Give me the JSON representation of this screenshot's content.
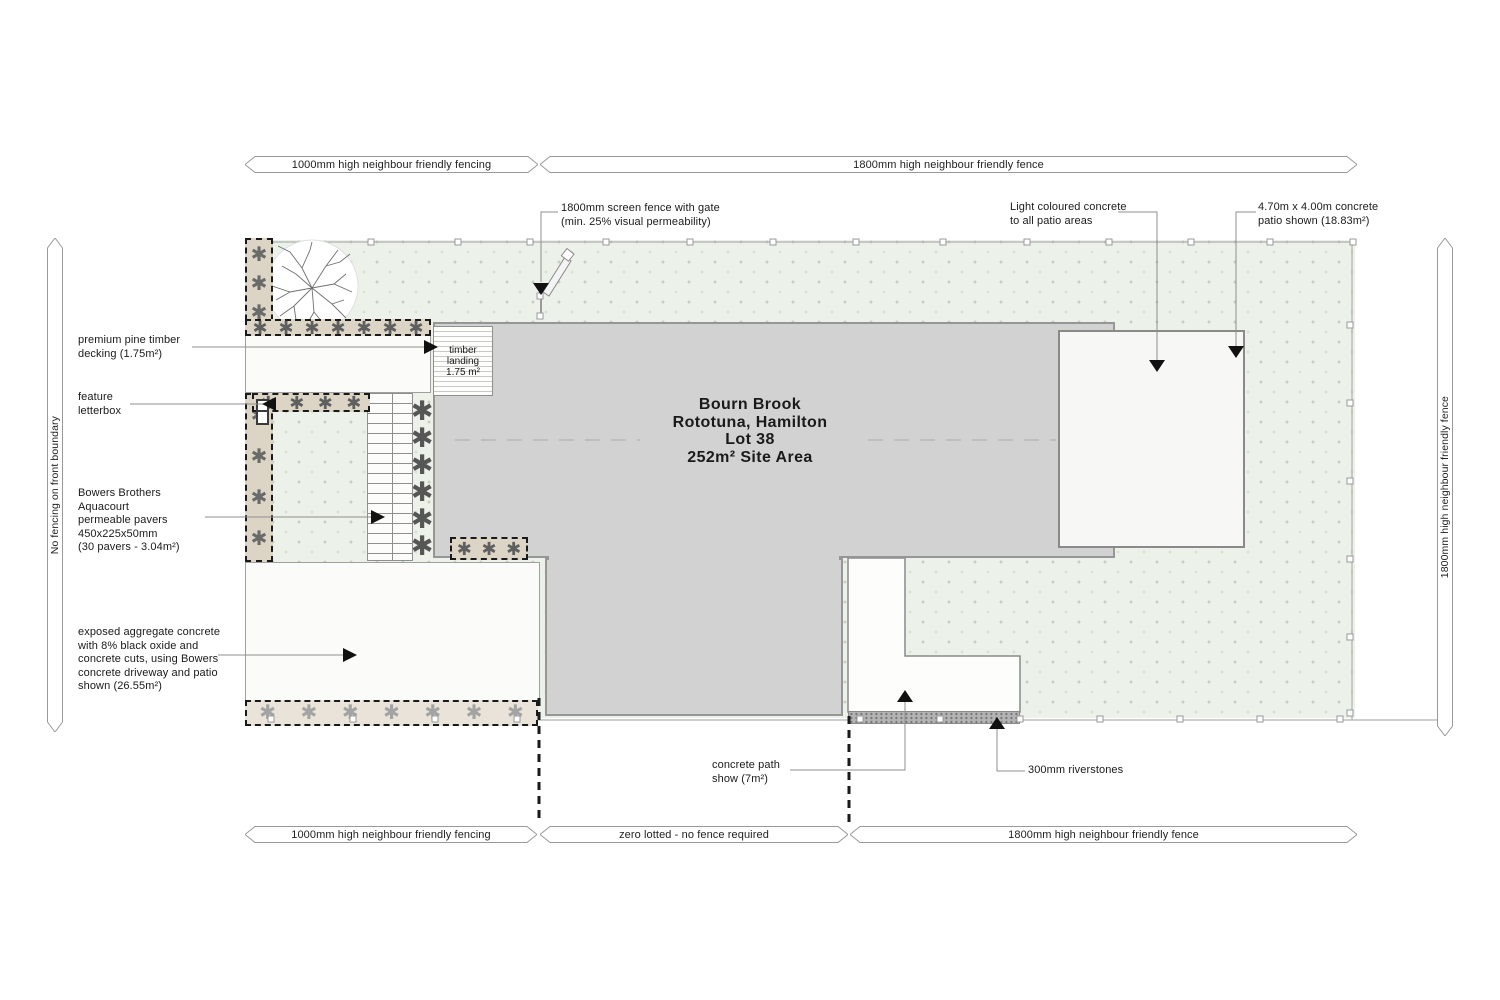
{
  "plan": {
    "title_lines": [
      "Bourn Brook",
      "Rototuna, Hamilton",
      "Lot 38",
      "252m² Site Area"
    ],
    "timber_landing": "timber\nlanding\n1.75 m²"
  },
  "fence_labels": {
    "top_left": "1000mm high neighbour friendly fencing",
    "top_right": "1800mm high neighbour friendly fence",
    "bottom_left": "1000mm high neighbour friendly fencing",
    "bottom_mid": "zero lotted - no fence required",
    "bottom_right": "1800mm high neighbour friendly fence",
    "left_vertical": "No fencing on front boundary",
    "right_vertical": "1800mm high neighbour friendly fence"
  },
  "annotations": {
    "screen_fence": "1800mm screen fence with gate\n(min. 25% visual permeability)",
    "light_concrete": "Light coloured concrete\nto all patio areas",
    "patio_size": "4.70m x 4.00m concrete\npatio shown (18.83m²)",
    "decking": "premium pine timber\ndecking (1.75m²)",
    "letterbox": "feature\nletterbox",
    "pavers": "Bowers Brothers\nAquacourt\npermeable pavers\n450x225x50mm\n(30 pavers - 3.04m²)",
    "aggregate": "exposed aggregate concrete\nwith 8% black oxide and\nconcrete cuts, using  Bowers\nconcrete driveway and patio\nshown (26.55m²)",
    "concrete_path": "concrete path\nshow (7m²)",
    "riverstones": "300mm riverstones"
  },
  "icons": {
    "shrub_glyph": "✱"
  },
  "colors": {
    "lawn": "#ecf1e9",
    "house": "#d2d2d2",
    "garden_bed": "#dcd5c6",
    "patio": "#f7f7f6",
    "boundary_dash": "#1a1a1a"
  }
}
